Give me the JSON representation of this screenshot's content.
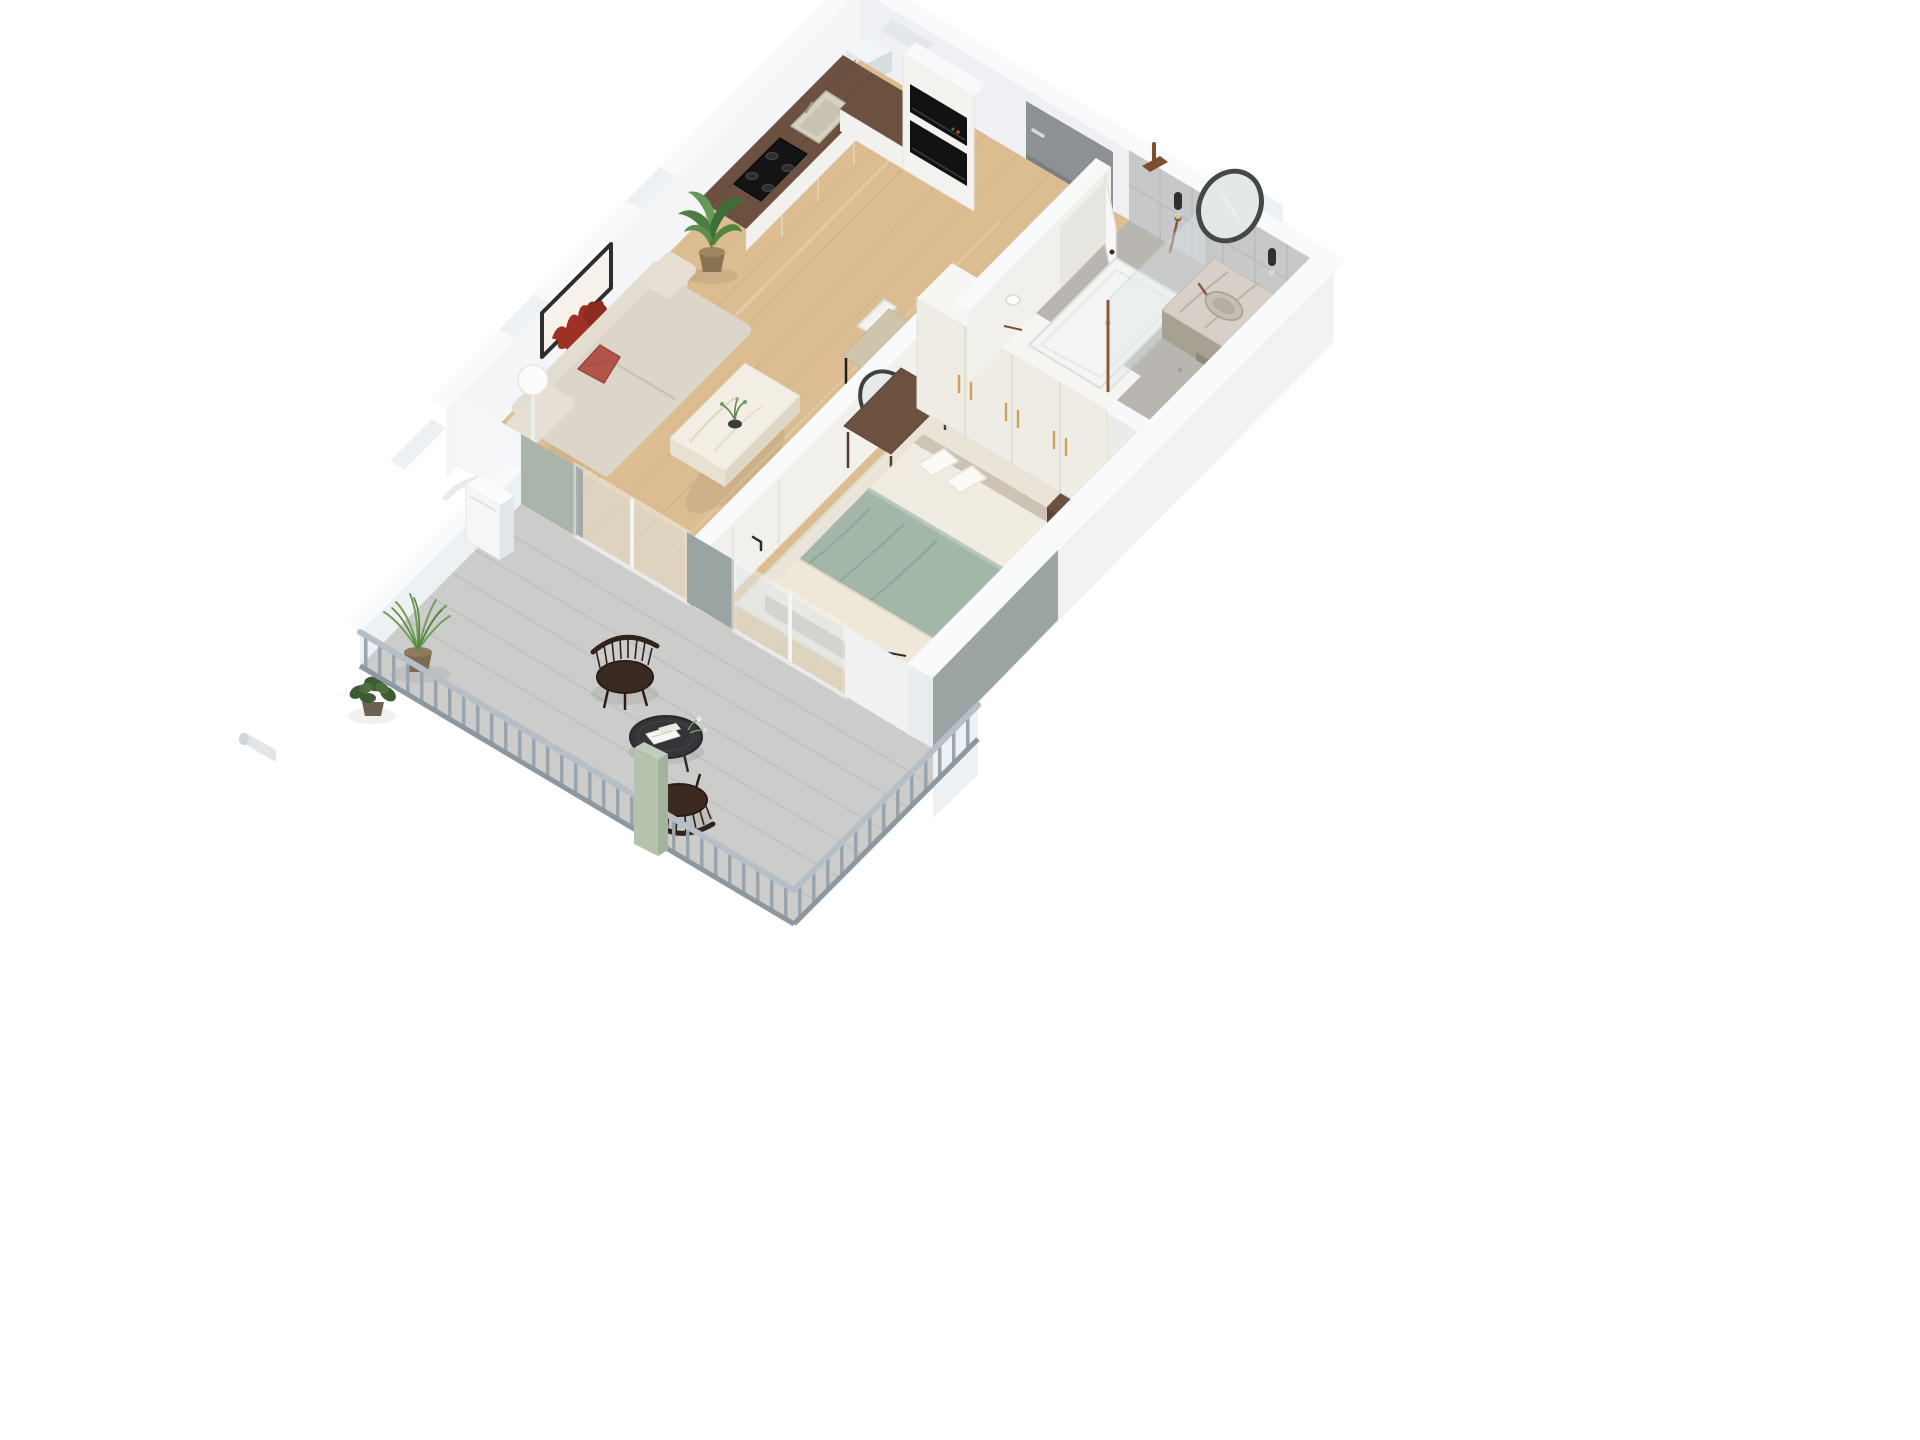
{
  "scene": {
    "title": "3D isometric floor plan render of a one-bedroom apartment",
    "view": "axonometric top-down, rotated, long axis lower-left to upper-right",
    "background": "#ffffff"
  },
  "palette": {
    "background": "#ffffff",
    "exterior_wall": "#f3f5f7",
    "wall_shaded": "#eef0f3",
    "wall_top": "#f9fafc",
    "interior_wall": "#f2f0ed",
    "wood_floor": "#dcbd92",
    "wood_plank_line": "#cfa87d",
    "balcony_deck": "#cccccb",
    "deck_plank_line": "#b9bab8",
    "bathroom_tile": "#c6c8c9",
    "terrazzo_floor": "#b9b6b2",
    "entry_door": "#8e9193",
    "sofa_beige": "#dcd5c9",
    "accent_red": "#b2544a",
    "art_red": "#9e3025",
    "marble": "#f2eee3",
    "walnut": "#6d5140",
    "kitchen_cabinet": "#f2f1ee",
    "appliance_black": "#141414",
    "bed_sage": "#a3b7a9",
    "bed_cream": "#efe8d9",
    "rug_cream": "#eae3d7",
    "wardrobe_white": "#efece6",
    "brass_gold": "#c9a45a",
    "vanity_olive": "#a7a193",
    "bronze_fixture": "#8a5a3a",
    "mirror_frame": "#45484a",
    "glass": "#dfe9ed",
    "accent_green_wall": "#a9b4ab",
    "accent_gray_wall": "#9aa5a4",
    "sage_column": "#b5c2ae",
    "railing_gray": "#9aa4ad",
    "chair_dark_wood": "#3a2a21",
    "plant_green": "#5e8f4f"
  },
  "rooms": [
    {
      "id": "living-room",
      "name": "Living room",
      "floor": "light oak wood",
      "furniture": [
        "beige curved sofa",
        "red throw pillow",
        "abstract red wall art",
        "marble coffee table",
        "black vase with greenery",
        "white globe floor lamp",
        "side table with books",
        "potted banana plant",
        "dining table",
        "white dining chairs"
      ]
    },
    {
      "id": "kitchen",
      "name": "Kitchen",
      "floor": "light oak wood",
      "furniture": [
        "L-shaped white cabinets",
        "walnut countertop",
        "black gas cooktop",
        "inset sink",
        "built-in oven",
        "built-in microwave",
        "tall appliance column"
      ]
    },
    {
      "id": "hallway",
      "name": "Entry hall",
      "floor": "light oak wood",
      "furniture": [
        "gray entry door"
      ]
    },
    {
      "id": "bedroom",
      "name": "Bedroom",
      "floor": "light oak wood",
      "furniture": [
        "double bed with sage duvet",
        "white pillows",
        "cream foot throw",
        "cream area rug",
        "walnut nightstand",
        "small table lamp",
        "white wardrobe with gold handles",
        "walnut vanity desk",
        "round leaning mirror",
        "wood chair with white seat",
        "magazines on floor"
      ]
    },
    {
      "id": "bathroom",
      "name": "Bathroom",
      "floor": "gray terrazzo",
      "furniture": [
        "walk-in shower tray",
        "glass shower screen",
        "bronze rain shower head",
        "bronze hand shower",
        "marble vanity top",
        "olive vanity cabinet",
        "round framed mirror",
        "two wall sconces",
        "toilet paper holder",
        "white bathroom door ajar"
      ]
    },
    {
      "id": "balcony",
      "name": "Balcony",
      "floor": "gray wood decking",
      "furniture": [
        "gray baluster railing",
        "sage green column",
        "two dark spindle armchairs",
        "round black side table",
        "magazines and flowers",
        "potted grass plant",
        "potted ivy",
        "air-conditioning unit",
        "exterior pipe"
      ]
    }
  ]
}
